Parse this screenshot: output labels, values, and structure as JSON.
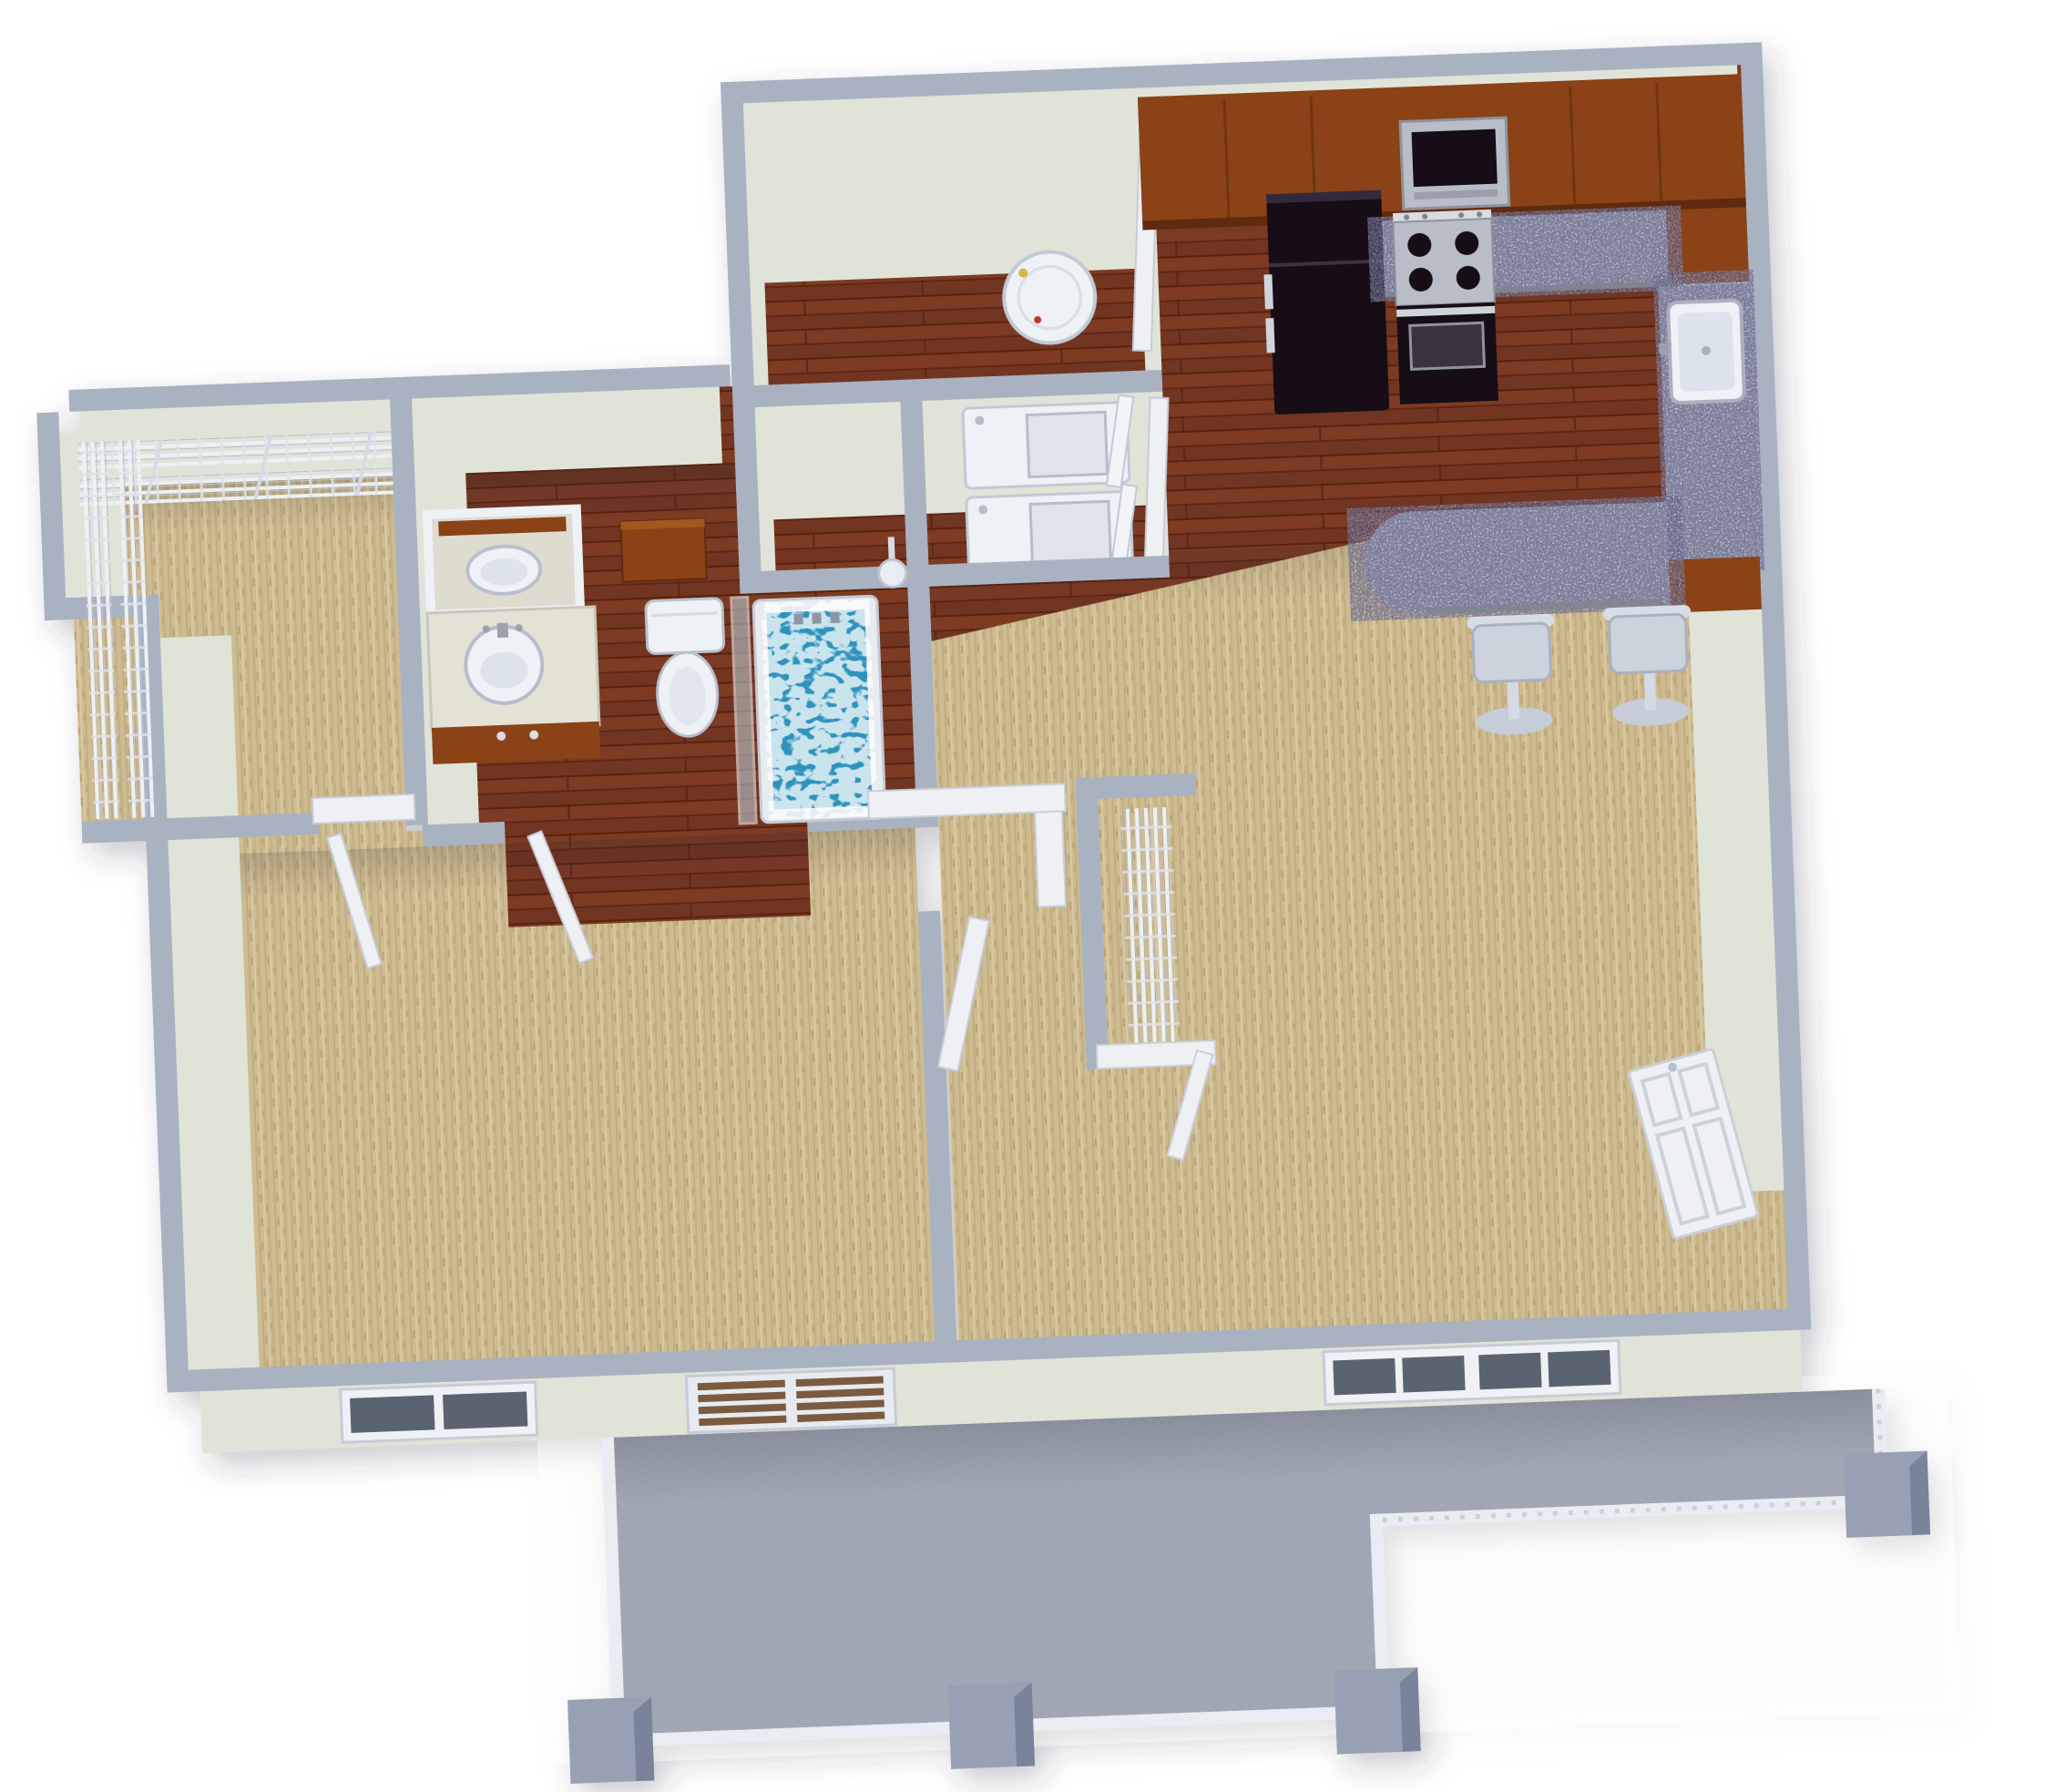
{
  "background": "#ffffff",
  "colors": {
    "wall_top": "#a9b2c1",
    "wall_edge": "#cfd7e2",
    "wall_face": "#e0e3d8",
    "wall_face_shade": "#c7ccc3",
    "wood_floor": "#7b3a24",
    "wood_floor_dark": "#5c2513",
    "carpet": "#cdbb92",
    "balcony_floor": "#959dab",
    "granite": "#a9aeb8",
    "granite_edge": "#7e8490",
    "cabinet_wood": "#8a4315",
    "cabinet_wood_dark": "#5f2c0c",
    "appliance_black": "#161118",
    "appliance_black_light": "#332b3a",
    "stainless": "#b8bdc7",
    "fixture_white": "#eef1f6",
    "fixture_shade": "#c6ccd7",
    "water": "#2e93bc",
    "glass": "#bcd3e2",
    "railing": "#e9edf3",
    "post": "#98a1b3",
    "post_dark": "#79839a",
    "door_white": "#eef0f4",
    "wire_shelf": "#edf0f5",
    "window_glass": "#5a6470",
    "patio_slat": "#7c5a3d"
  },
  "unit": {
    "type": "one-bedroom-apartment-3d-floor-plan",
    "rooms": [
      {
        "id": "kitchen",
        "floor": "hardwood",
        "features": [
          "upper-cabinets",
          "microwave",
          "refrigerator",
          "range-oven",
          "granite-counter",
          "kitchen-sink",
          "breakfast-bar"
        ]
      },
      {
        "id": "laundry-closet",
        "floor": "hardwood",
        "features": [
          "water-heater",
          "washer",
          "dryer"
        ]
      },
      {
        "id": "bathroom",
        "floor": "hardwood",
        "features": [
          "pass-through-sink",
          "vanity-sink",
          "medicine-cabinet",
          "toilet",
          "bathtub",
          "shower-head",
          "glass-panel"
        ]
      },
      {
        "id": "walk-in-closet",
        "floor": "carpet",
        "features": [
          "wire-shelving"
        ]
      },
      {
        "id": "bedroom",
        "floor": "carpet",
        "features": [
          "window"
        ]
      },
      {
        "id": "living-room",
        "floor": "carpet",
        "features": [
          "double-window",
          "linen-closet",
          "entry-door",
          "bar-stools"
        ]
      },
      {
        "id": "balcony",
        "floor": "concrete",
        "features": [
          "railing",
          "corner-posts",
          "patio-door"
        ]
      }
    ]
  }
}
